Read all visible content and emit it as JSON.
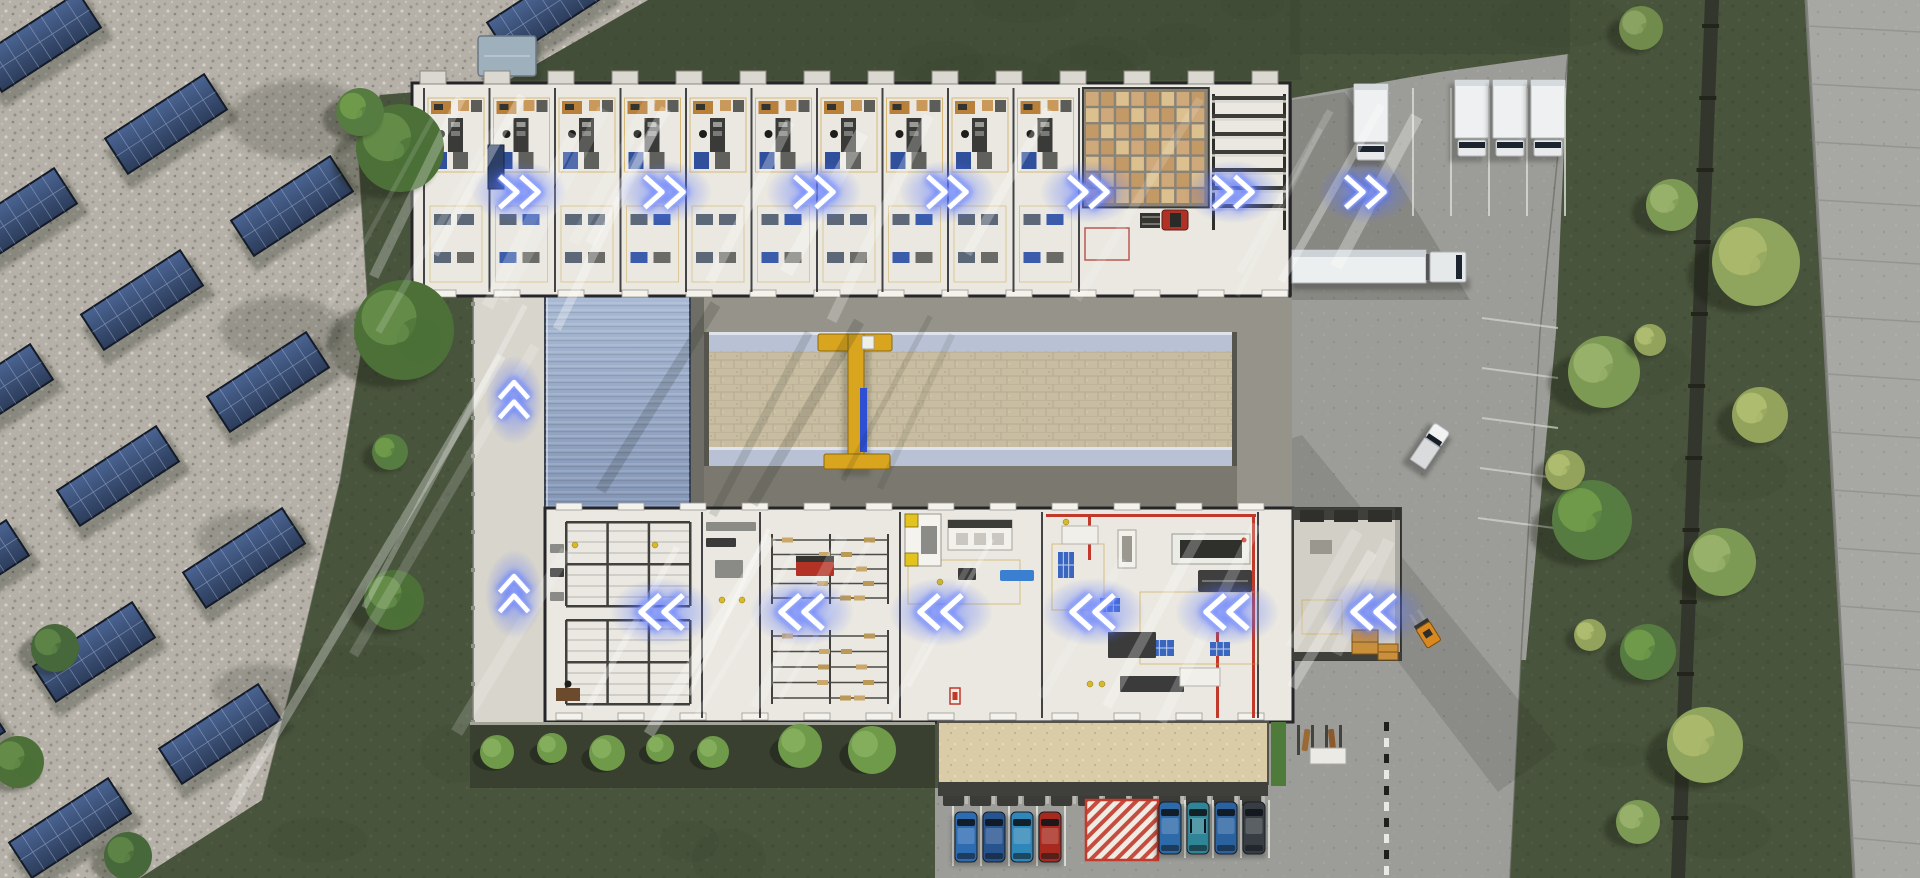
{
  "meta": {
    "title": "Aerial 3D render of a factory campus with glowing material-flow chevron arrows",
    "canvas": {
      "width": 1920,
      "height": 878
    }
  },
  "palette": {
    "grass": "#49543d",
    "grassDark": "#3c4733",
    "gravel": "#b5b1a8",
    "asphalt": "#9c9c98",
    "road": "#a7a7a3",
    "roadEdge": "#7e7e7a",
    "pipe": "#33362c",
    "floor": "#eae8e1",
    "floorDock": "#d2cfc6",
    "wall": "#26262a",
    "corridor": "#d8d5cc",
    "apron": "#95938a",
    "apronDark": "#7b796f",
    "blueRoof": "#8ea2c0",
    "runwayBeam": "#b9c2d4",
    "paver": "#c8bda0",
    "craneYellow": "#d9a41e",
    "craneBlue": "#2c4fd4",
    "hedge": "#39402f",
    "entranceRoof": "#dacca7",
    "woodDesk": "#b9803a",
    "palletTan": "#cfa97a",
    "palletGap": "#8a8478",
    "rackBar": "#3f3f3c",
    "machineDark": "#3b3b3b",
    "machineGray": "#8a8a86",
    "zoneYellow": "#c9a23e",
    "safetyRed": "#c0392b",
    "bluePallet": "#3a66c0",
    "blueMat": "#31509c",
    "arrowCore": "#ffffff",
    "arrowMid": "#9db0ff",
    "arrowHalo": "#3e5cff",
    "truckWhite": "#eef0f1",
    "windshield": "#1c2430",
    "forkliftRed": "#b03226",
    "forkliftOrange": "#d8881f",
    "hatchRed": "#c23b2d",
    "shed": "#9fb0bd"
  },
  "flow_arrows": {
    "top_row": {
      "direction": "right",
      "y": 192,
      "x_positions": [
        519,
        664,
        814,
        947,
        1088,
        1233,
        1365
      ]
    },
    "side_corridor": {
      "direction": "up",
      "x": 514,
      "y_positions": [
        400,
        594
      ]
    },
    "bottom_row": {
      "direction": "left",
      "y": 612,
      "x_positions": [
        662,
        802,
        941,
        1093,
        1227,
        1374
      ]
    }
  },
  "solar_field": {
    "rotation_deg": -33,
    "panel_size": [
      118,
      42
    ],
    "panel_positions": [
      [
        40,
        42
      ],
      [
        166,
        124
      ],
      [
        292,
        206
      ],
      [
        16,
        218
      ],
      [
        142,
        300
      ],
      [
        268,
        382
      ],
      [
        -8,
        394
      ],
      [
        118,
        476
      ],
      [
        244,
        558
      ],
      [
        -32,
        570
      ],
      [
        94,
        652
      ],
      [
        220,
        734
      ],
      [
        -56,
        746
      ],
      [
        70,
        828
      ],
      [
        548,
        8
      ]
    ]
  },
  "top_building": {
    "x": 412,
    "y": 83,
    "w": 878,
    "h": 213,
    "office_bays": {
      "count": 10,
      "start_x": 424,
      "bay_width": 65.5
    },
    "pallet_grid": {
      "x": 1086,
      "y": 92,
      "cols": 8,
      "rows": 7,
      "cell_w": 12.6,
      "cell_h": 13.8
    },
    "rack_bars": {
      "x": 1212,
      "y": 96,
      "count": 7,
      "spacing": 18,
      "width": 74
    },
    "red_zone": [
      1085,
      228,
      44,
      32
    ]
  },
  "bottom_building": {
    "x": 545,
    "y": 508,
    "w": 748,
    "h": 214,
    "wall_x": [
      702,
      760,
      900,
      1042,
      1258
    ],
    "red_lines": [
      [
        1046,
        514,
        210,
        3
      ],
      [
        1252,
        514,
        3,
        204
      ],
      [
        1088,
        514,
        3,
        46
      ],
      [
        1216,
        632,
        3,
        86
      ]
    ],
    "yellow_zones": [
      [
        1052,
        544,
        52,
        66
      ],
      [
        1140,
        592,
        118,
        72
      ],
      [
        908,
        560,
        112,
        44
      ]
    ],
    "rack_clusters": [
      [
        566,
        522,
        124,
        84
      ],
      [
        566,
        620,
        124,
        84
      ]
    ],
    "shelf_regions": [
      [
        772,
        540,
        116,
        58
      ],
      [
        772,
        636,
        116,
        62
      ]
    ],
    "items": [
      [
        "yellowmachine",
        905,
        514,
        36,
        52
      ],
      [
        "whitemachine",
        948,
        520,
        64,
        30
      ],
      [
        "bluemat",
        1000,
        570,
        34,
        11
      ],
      [
        "darkbox",
        958,
        568,
        18,
        12
      ],
      [
        "table",
        1062,
        526,
        36,
        18
      ],
      [
        "vmachine",
        1118,
        530,
        18,
        38
      ],
      [
        "cnc",
        1172,
        534,
        78,
        30
      ],
      [
        "darkmachine",
        1198,
        570,
        54,
        22
      ],
      [
        "bluegrid",
        1058,
        552,
        16,
        26
      ],
      [
        "bluegrid",
        1100,
        598,
        20,
        14
      ],
      [
        "bluegrid",
        1152,
        640,
        22,
        16
      ],
      [
        "bluegrid",
        1210,
        642,
        20,
        14
      ],
      [
        "darkbox",
        1108,
        632,
        48,
        26
      ],
      [
        "darkbox",
        1120,
        676,
        64,
        16
      ],
      [
        "table",
        1180,
        668,
        40,
        18
      ],
      [
        "redbox",
        796,
        556,
        38,
        20
      ],
      [
        "graybox",
        706,
        522,
        50,
        9
      ],
      [
        "graybox",
        715,
        560,
        28,
        18
      ],
      [
        "darkbox",
        706,
        538,
        30,
        9
      ],
      [
        "wooddesk",
        556,
        688,
        24,
        13
      ],
      [
        "graybox",
        550,
        544,
        14,
        9
      ],
      [
        "darkbox",
        550,
        568,
        14,
        9
      ],
      [
        "graybox",
        550,
        592,
        14,
        9
      ],
      [
        "redstand",
        950,
        688,
        10,
        16
      ]
    ],
    "yellow_dots": [
      [
        722,
        600
      ],
      [
        742,
        600
      ],
      [
        575,
        545
      ],
      [
        655,
        545
      ],
      [
        940,
        582
      ],
      [
        1066,
        522
      ],
      [
        1090,
        684
      ],
      [
        1102,
        684
      ]
    ]
  },
  "campus": {
    "corridor": {
      "x": 473,
      "y": 296,
      "w": 72,
      "h": 426
    },
    "blue_roof": {
      "x": 545,
      "y": 296,
      "w": 145,
      "h": 214,
      "rib_step": 7
    },
    "crane_yard": {
      "x": 704,
      "y": 332,
      "w": 533,
      "beam_h": 19,
      "paver_h": 96
    },
    "crane": {
      "bar": [
        818,
        334,
        74,
        17
      ],
      "mast": [
        848,
        334,
        16,
        134
      ],
      "foot": [
        824,
        454,
        66,
        15
      ],
      "hose": [
        860,
        388,
        7,
        64
      ],
      "trolley": [
        862,
        336,
        12,
        13
      ]
    },
    "shed": [
      478,
      36,
      58,
      40
    ]
  },
  "entrance": {
    "hedge_bed": [
      470,
      722,
      465,
      66
    ],
    "bushes": [
      [
        497,
        752,
        17
      ],
      [
        552,
        748,
        15
      ],
      [
        607,
        753,
        18
      ],
      [
        660,
        748,
        14
      ],
      [
        713,
        752,
        16
      ],
      [
        800,
        746,
        22
      ],
      [
        872,
        750,
        24
      ]
    ],
    "roof": [
      938,
      722,
      330,
      62
    ],
    "green_strip": [
      1271,
      722,
      15,
      64
    ],
    "bike_racks": [
      1297,
      725,
      54,
      40
    ]
  },
  "parking": {
    "comb_row": {
      "x": 943,
      "y": 792,
      "count": 12,
      "step": 27
    },
    "stall_lines_left": [
      952,
      980,
      1008,
      1036,
      1064
    ],
    "stall_lines_right": [
      1156,
      1184,
      1212,
      1240,
      1268
    ],
    "hatch_zone": [
      1086,
      800,
      72,
      60
    ],
    "curb_x": 1384,
    "cars_left": {
      "y": 812,
      "h": 50,
      "w": 22,
      "x_positions": [
        955,
        983,
        1011,
        1039
      ],
      "colors": [
        "#2e6cb2",
        "#27548f",
        "#2f86b8",
        "#a82a1e"
      ]
    },
    "cars_right": {
      "y": 802,
      "h": 52,
      "w": 22,
      "x_positions": [
        1159,
        1187,
        1215,
        1243
      ],
      "colors": [
        "#2d6aa8",
        "#2f8496",
        "#2a62a0",
        "#383d44"
      ]
    },
    "side_stripes": [
      [
        1482,
        318
      ],
      [
        1482,
        368
      ],
      [
        1482,
        418
      ],
      [
        1480,
        468
      ],
      [
        1478,
        518
      ]
    ]
  },
  "vehicles": {
    "parked_box_trucks": [
      [
        1354,
        84
      ],
      [
        1455,
        80
      ],
      [
        1493,
        80
      ],
      [
        1531,
        80
      ]
    ],
    "truck_stall_lines": [
      1412,
      1450,
      1488,
      1526,
      1564
    ],
    "semi_truck": {
      "x": 1292,
      "y": 249,
      "heading": "east"
    },
    "pickup": {
      "x": 1430,
      "y": 446,
      "rotation": 34
    },
    "forklift_red": [
      1164,
      212
    ],
    "forklift_orange": {
      "x": 1428,
      "y": 634,
      "rotation": -32
    },
    "pallet_stacks": [
      [
        1352,
        630,
        26,
        24
      ],
      [
        1378,
        644,
        20,
        16
      ]
    ]
  },
  "vegetation": {
    "trees": [
      [
        400,
        148,
        44,
        "g1"
      ],
      [
        360,
        112,
        24,
        "g2"
      ],
      [
        404,
        330,
        50,
        "g1"
      ],
      [
        390,
        452,
        18,
        "g2"
      ],
      [
        394,
        600,
        30,
        "g1"
      ],
      [
        55,
        648,
        24,
        "g3"
      ],
      [
        18,
        762,
        26,
        "g1"
      ],
      [
        128,
        856,
        24,
        "g3"
      ],
      [
        1641,
        28,
        22,
        "o1"
      ],
      [
        1672,
        205,
        26,
        "o2"
      ],
      [
        1604,
        372,
        36,
        "o2"
      ],
      [
        1592,
        520,
        40,
        "g2"
      ],
      [
        1756,
        262,
        44,
        "y1"
      ],
      [
        1760,
        415,
        28,
        "y2"
      ],
      [
        1650,
        340,
        16,
        "y2"
      ],
      [
        1722,
        562,
        34,
        "o2"
      ],
      [
        1648,
        652,
        28,
        "g2"
      ],
      [
        1705,
        745,
        38,
        "y1"
      ],
      [
        1638,
        822,
        22,
        "o2"
      ],
      [
        1565,
        470,
        20,
        "y2"
      ],
      [
        1590,
        635,
        16,
        "y2"
      ]
    ],
    "tree_colors": {
      "g1": [
        "#4c7038",
        "#648c48"
      ],
      "g2": [
        "#567c42",
        "#6f9a4a"
      ],
      "g3": [
        "#47683a",
        "#5d8446"
      ],
      "o1": [
        "#708b4c",
        "#8aa362"
      ],
      "o2": [
        "#7d9a55",
        "#97b06a"
      ],
      "y1": [
        "#8fa45c",
        "#aab86c"
      ],
      "y2": [
        "#93a35c",
        "#adbc6e"
      ]
    }
  },
  "ground": {
    "gravel_polygon": [
      [
        0,
        0
      ],
      [
        648,
        0
      ],
      [
        500,
        85
      ],
      [
        380,
        95
      ],
      [
        358,
        150
      ],
      [
        368,
        310
      ],
      [
        340,
        480
      ],
      [
        300,
        650
      ],
      [
        262,
        800
      ],
      [
        140,
        878
      ],
      [
        0,
        878
      ]
    ],
    "asphalt_polygons": [
      [
        [
          1292,
          98
        ],
        [
          1440,
          72
        ],
        [
          1568,
          54
        ],
        [
          1556,
          332
        ],
        [
          1240,
          332
        ],
        [
          1240,
          296
        ],
        [
          1292,
          296
        ]
      ],
      [
        [
          1240,
          332
        ],
        [
          1556,
          332
        ],
        [
          1526,
          660
        ],
        [
          1240,
          660
        ]
      ],
      [
        [
          935,
          788
        ],
        [
          1268,
          788
        ],
        [
          1268,
          722
        ],
        [
          1293,
          722
        ],
        [
          1293,
          640
        ],
        [
          1522,
          640
        ],
        [
          1510,
          878
        ],
        [
          935,
          878
        ]
      ]
    ],
    "road_polygon": [
      [
        1806,
        0
      ],
      [
        1920,
        0
      ],
      [
        1920,
        878
      ],
      [
        1854,
        878
      ]
    ],
    "pipe_polygon": [
      [
        1705,
        0
      ],
      [
        1719,
        0
      ],
      [
        1685,
        878
      ],
      [
        1671,
        878
      ]
    ],
    "fence_line": [
      [
        1568,
        54
      ],
      [
        1540,
        332
      ],
      [
        1522,
        640
      ],
      [
        1510,
        878
      ]
    ],
    "gravel_fence": [
      [
        380,
        95
      ],
      [
        358,
        150
      ],
      [
        368,
        310
      ],
      [
        340,
        480
      ],
      [
        300,
        650
      ],
      [
        262,
        800
      ]
    ]
  }
}
